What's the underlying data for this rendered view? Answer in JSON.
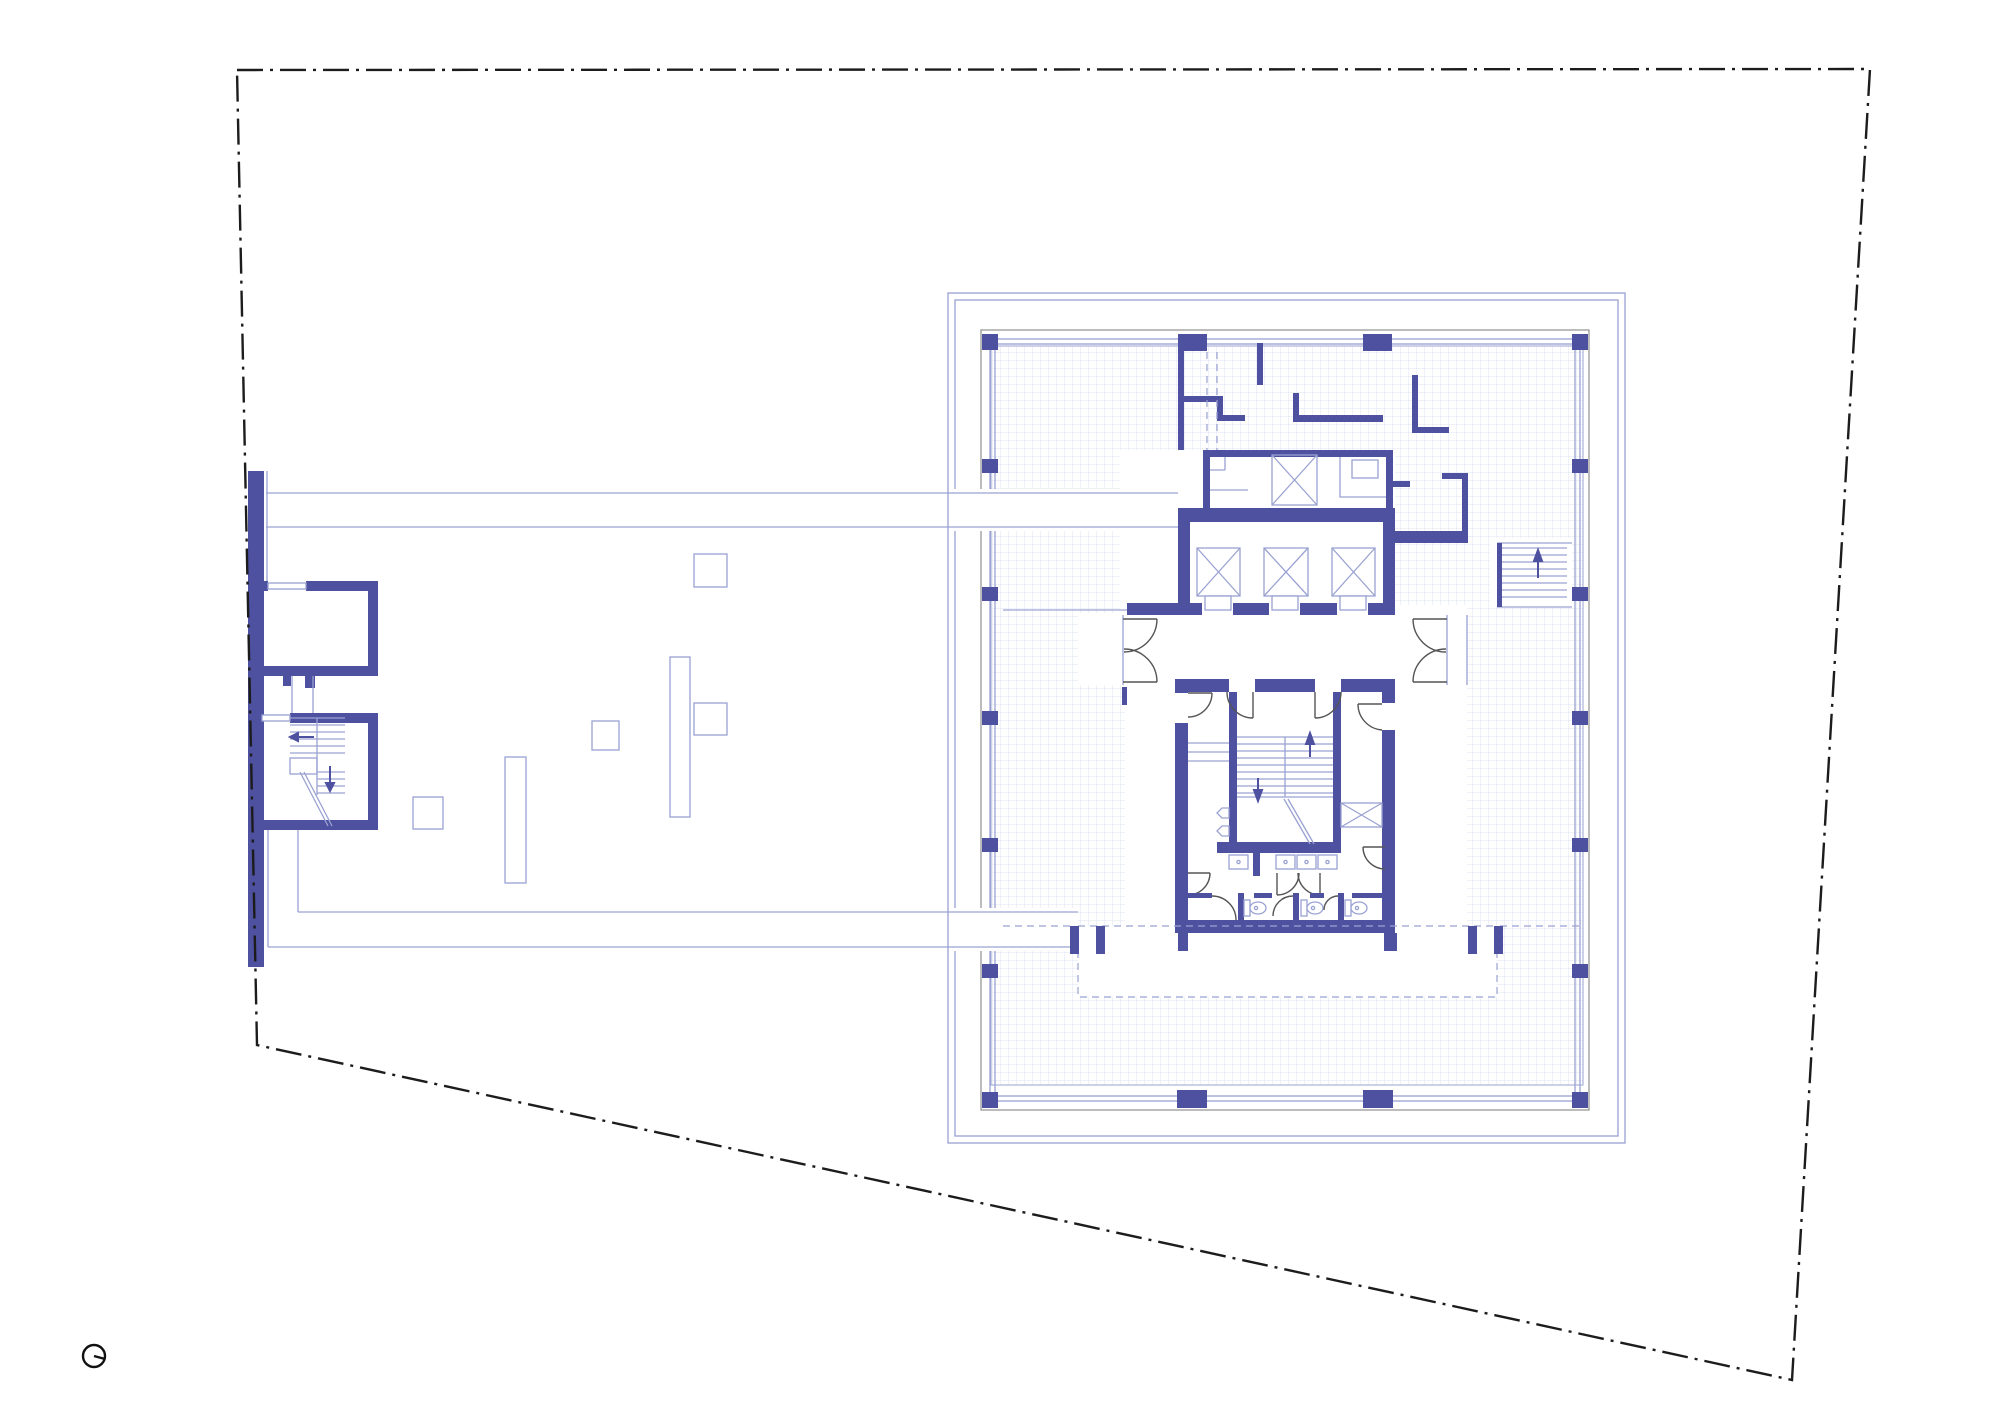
{
  "sheet": {
    "kind": "architectural floor plan",
    "description": "Roof / typical floor plan: dash-dot site boundary, low podium roof with rooflights and two service rooms at left, tower floor plate at right with perimeter columns, elevator bank, machine room, central stair core and toilets",
    "width_px": 2000,
    "height_px": 1415,
    "background": "#ffffff"
  },
  "colors": {
    "wall": "#4e50a0",
    "thin": "#9aa2d2",
    "grid": "#dfe3f1",
    "facade": "#8f8f8f",
    "door": "#555555",
    "boundary": "#1c1c1c",
    "ink": "#111111"
  },
  "site": {
    "boundary_line_style": "dash-dot property line",
    "boundary_shape": "four-sided, slightly tapered, diagonal south edge"
  },
  "north_arrow": {
    "symbol": "circle with radius line",
    "pointer_direction": "east-southeast"
  },
  "podium": {
    "outline": "double thin line roof edge",
    "rooflight_count": 6,
    "rooms": [
      {
        "name": "plant room",
        "doors": 1
      },
      {
        "name": "stair room",
        "features": [
          "treads",
          "landing",
          "up arrow",
          "down arrow",
          "diagonal break line"
        ]
      }
    ]
  },
  "tower": {
    "slab_edge": "double thin line",
    "facade_line": "gray line with double mullion line and perimeter columns",
    "perimeter_column_count": 20,
    "floor_finish": "fine square grid",
    "elevator_bank": {
      "shaft_count": 3,
      "symbol": "crossed box with door recess"
    },
    "machine_room": {
      "service_lift_shafts": 1
    },
    "lobby": {
      "double_doors": 2
    },
    "core": {
      "stair": {
        "flights": 2,
        "arrows": [
          "up",
          "down"
        ]
      },
      "toilets": {
        "wc_count": 3,
        "washbasin_count": 4,
        "urinal_count": 2,
        "duct_shafts": 1
      },
      "setback": "dashed outline zone below core"
    },
    "external_stair": {
      "location": "east side of service zone",
      "arrow": "up"
    }
  }
}
